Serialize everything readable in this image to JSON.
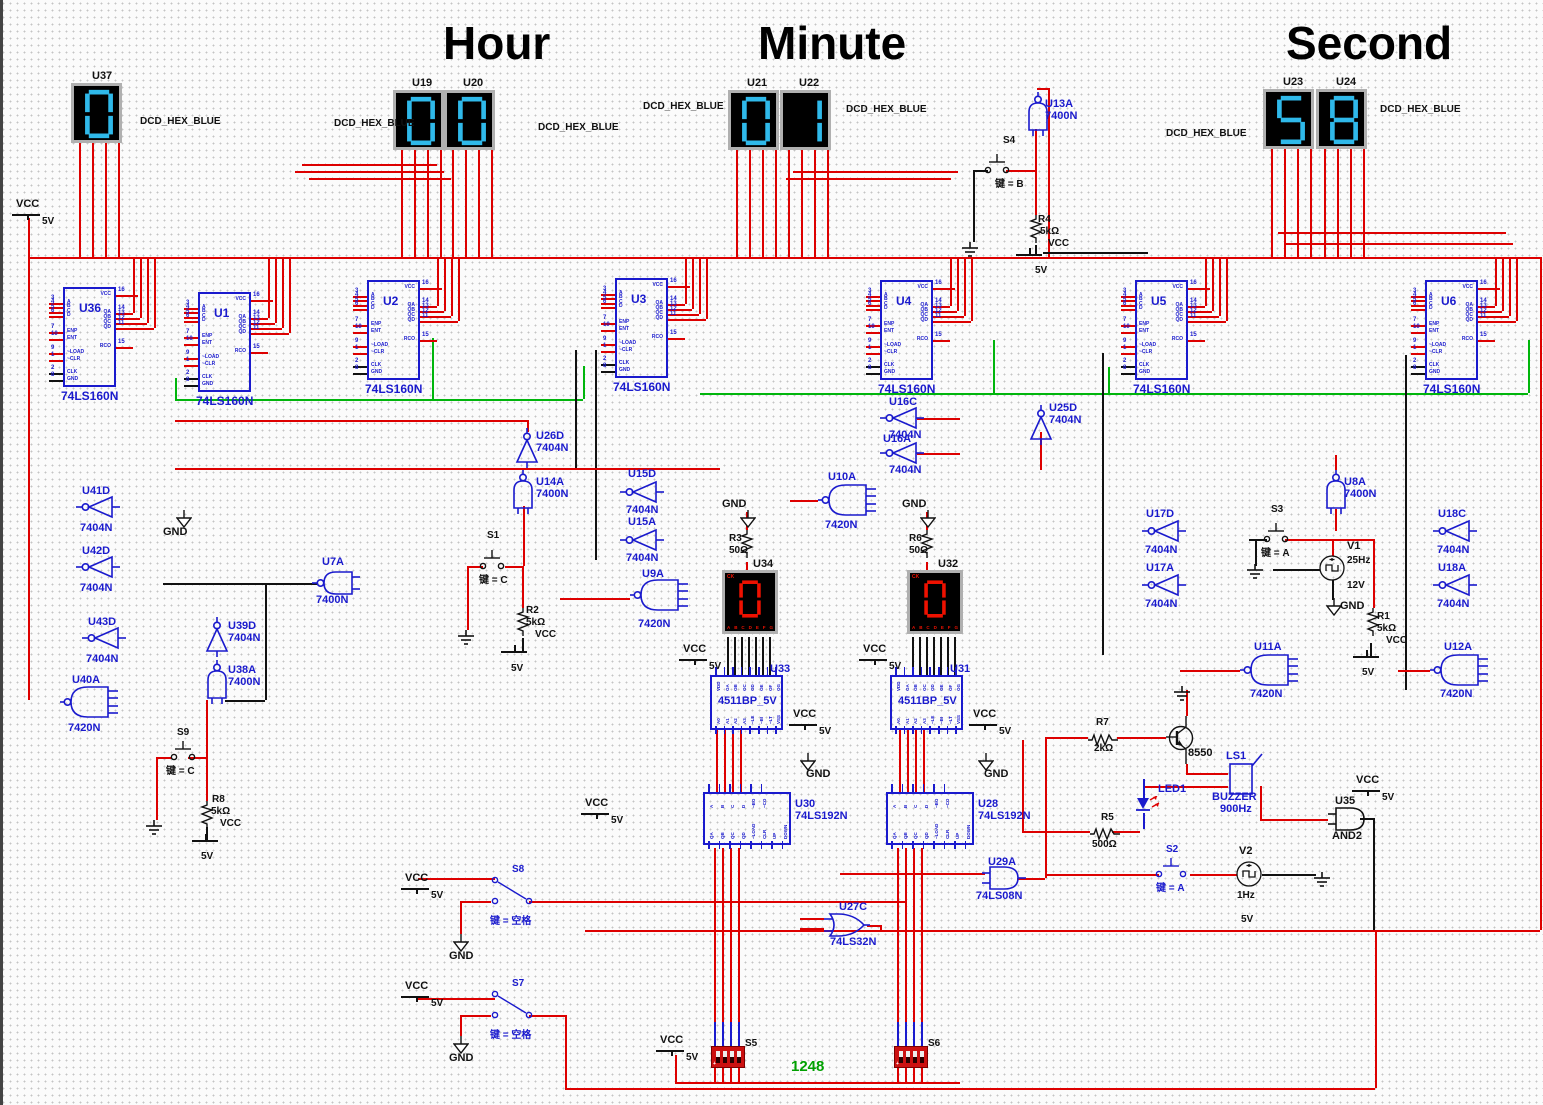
{
  "titles": {
    "hour": "Hour",
    "minute": "Minute",
    "second": "Second"
  },
  "colors": {
    "wire_red": "#dd0000",
    "wire_green": "#00b50c",
    "wire_black": "#111111",
    "component_blue": "#1a1acd",
    "segment_blue": "#2fb9ea",
    "segment_red": "#ee1100",
    "dip_red": "#cc1111",
    "label_green": "#00a000"
  },
  "display_captions": [
    {
      "text": "DCD_HEX_BLUE",
      "x": 140,
      "y": 116
    },
    {
      "text": "DCD_HEX_BLUE",
      "x": 334,
      "y": 118
    },
    {
      "text": "DCD_HEX_BLUE",
      "x": 538,
      "y": 122
    },
    {
      "text": "DCD_HEX_BLUE",
      "x": 643,
      "y": 101
    },
    {
      "text": "DCD_HEX_BLUE",
      "x": 846,
      "y": 104
    },
    {
      "text": "DCD_HEX_BLUE",
      "x": 1166,
      "y": 128
    },
    {
      "text": "DCD_HEX_BLUE",
      "x": 1380,
      "y": 104
    }
  ],
  "displays": [
    {
      "id": "U37",
      "digit": "0",
      "color": "blue",
      "x": 71,
      "y": 83,
      "lx": 92,
      "ly": 70
    },
    {
      "id": "U19",
      "digit": "0",
      "color": "blue",
      "x": 393,
      "y": 90,
      "lx": 412,
      "ly": 77
    },
    {
      "id": "U20",
      "digit": "0",
      "color": "blue",
      "x": 444,
      "y": 90,
      "lx": 463,
      "ly": 77
    },
    {
      "id": "U21",
      "digit": "0",
      "color": "blue",
      "x": 728,
      "y": 90,
      "lx": 747,
      "ly": 77
    },
    {
      "id": "U22",
      "digit": "1",
      "color": "blue",
      "x": 780,
      "y": 90,
      "lx": 799,
      "ly": 77
    },
    {
      "id": "U23",
      "digit": "5",
      "color": "blue",
      "x": 1263,
      "y": 89,
      "lx": 1283,
      "ly": 76
    },
    {
      "id": "U24",
      "digit": "8",
      "color": "blue",
      "x": 1316,
      "y": 89,
      "lx": 1336,
      "ly": 76
    },
    {
      "id": "U34",
      "digit": "0",
      "color": "red",
      "x": 722,
      "y": 570,
      "lx": 753,
      "ly": 558
    },
    {
      "id": "U32",
      "digit": "0",
      "color": "red",
      "x": 907,
      "y": 570,
      "lx": 938,
      "ly": 558
    }
  ],
  "red_display": {
    "ck": "CK",
    "pins": [
      "A",
      "B",
      "C",
      "D",
      "E",
      "F",
      "G"
    ]
  },
  "counters": {
    "part": "74LS160N",
    "left_pins": [
      "A",
      "B",
      "C",
      "D",
      "ENP",
      "ENT",
      "~LOAD",
      "~CLR",
      "CLK",
      "GND"
    ],
    "left_nums": [
      "3",
      "4",
      "5",
      "6",
      "7",
      "10",
      "9",
      "1",
      "2",
      "8"
    ],
    "left_offs": [
      16,
      20,
      25,
      29,
      45,
      52,
      66,
      73,
      86,
      93
    ],
    "right_pins": [
      "VCC",
      "QA",
      "QB",
      "QC",
      "QD",
      "RCO"
    ],
    "right_nums": [
      "16",
      "14",
      "13",
      "12",
      "11",
      "15"
    ],
    "right_offs": [
      8,
      26,
      31,
      36,
      41,
      60
    ],
    "items": [
      {
        "id": "U36",
        "x": 63,
        "y": 287
      },
      {
        "id": "U1",
        "x": 198,
        "y": 292
      },
      {
        "id": "U2",
        "x": 367,
        "y": 280
      },
      {
        "id": "U3",
        "x": 615,
        "y": 278
      },
      {
        "id": "U4",
        "x": 880,
        "y": 280
      },
      {
        "id": "U5",
        "x": 1135,
        "y": 280
      },
      {
        "id": "U6",
        "x": 1425,
        "y": 280
      }
    ]
  },
  "decoders": {
    "part": "4511BP_5V",
    "top_pins": [
      "VDD",
      "OA",
      "OB",
      "OC",
      "OD",
      "OE",
      "OF",
      "OG"
    ],
    "bottom_pins": [
      "A0",
      "A1",
      "A2",
      "A3",
      "~LE",
      "~BI",
      "~LT",
      "VSS"
    ],
    "items": [
      {
        "id": "U33",
        "x": 710,
        "y": 675
      },
      {
        "id": "U31",
        "x": 890,
        "y": 675
      }
    ]
  },
  "updown_counters": {
    "part": "74LS192N",
    "top_pins": [
      "A",
      "B",
      "C",
      "D",
      "~BO",
      "~CO"
    ],
    "bottom_pins": [
      "QA",
      "QB",
      "QC",
      "QD",
      "~LOAD",
      "CLR",
      "UP",
      "DOWN"
    ],
    "items": [
      {
        "id": "U30",
        "x": 703,
        "y": 792
      },
      {
        "id": "U28",
        "x": 886,
        "y": 792
      }
    ]
  },
  "gates": [
    {
      "id": "U41D",
      "part": "7404N",
      "type": "inv",
      "orient": "left",
      "x": 76,
      "y": 495,
      "ix": 82,
      "iy": 485,
      "px": 80,
      "py": 522
    },
    {
      "id": "U42D",
      "part": "7404N",
      "type": "inv",
      "orient": "left",
      "x": 76,
      "y": 555,
      "ix": 82,
      "iy": 545,
      "px": 80,
      "py": 582
    },
    {
      "id": "U43D",
      "part": "7404N",
      "type": "inv",
      "orient": "left",
      "x": 82,
      "y": 626,
      "ix": 88,
      "iy": 616,
      "px": 86,
      "py": 653
    },
    {
      "id": "U40A",
      "part": "7420N",
      "type": "nand4",
      "orient": "left",
      "x": 60,
      "y": 685,
      "ix": 72,
      "iy": 674,
      "px": 68,
      "py": 722
    },
    {
      "id": "U39D",
      "part": "7404N",
      "type": "inv",
      "orient": "up",
      "x": 205,
      "y": 617,
      "ix": 228,
      "iy": 620,
      "px": 228,
      "py": 632
    },
    {
      "id": "U38A",
      "part": "7400N",
      "type": "nand2",
      "orient": "up",
      "x": 205,
      "y": 660,
      "ix": 228,
      "iy": 664,
      "px": 228,
      "py": 676
    },
    {
      "id": "U7A",
      "part": "7400N",
      "type": "nand2",
      "orient": "left",
      "x": 312,
      "y": 570,
      "ix": 322,
      "iy": 556,
      "px": 316,
      "py": 594
    },
    {
      "id": "U26D",
      "part": "7404N",
      "type": "inv",
      "orient": "up",
      "x": 515,
      "y": 428,
      "ix": 536,
      "iy": 430,
      "px": 536,
      "py": 442
    },
    {
      "id": "U14A",
      "part": "7400N",
      "type": "nand2",
      "orient": "up",
      "x": 511,
      "y": 470,
      "ix": 536,
      "iy": 476,
      "px": 536,
      "py": 488
    },
    {
      "id": "U15D",
      "part": "7404N",
      "type": "inv",
      "orient": "left",
      "x": 620,
      "y": 480,
      "ix": 628,
      "iy": 468,
      "px": 626,
      "py": 504
    },
    {
      "id": "U15A",
      "part": "7404N",
      "type": "inv",
      "orient": "left",
      "x": 620,
      "y": 528,
      "ix": 628,
      "iy": 516,
      "px": 626,
      "py": 552
    },
    {
      "id": "U9A",
      "part": "7420N",
      "type": "nand4",
      "orient": "left",
      "x": 630,
      "y": 578,
      "ix": 642,
      "iy": 568,
      "px": 638,
      "py": 618
    },
    {
      "id": "U13A",
      "part": "7400N",
      "type": "nand2",
      "orient": "up",
      "x": 1026,
      "y": 92,
      "ix": 1045,
      "iy": 98,
      "px": 1045,
      "py": 110
    },
    {
      "id": "U16C",
      "part": "7404N",
      "type": "inv",
      "orient": "left",
      "x": 880,
      "y": 406,
      "ix": 889,
      "iy": 396,
      "px": 889,
      "py": 429
    },
    {
      "id": "U16A",
      "part": "7404N",
      "type": "inv",
      "orient": "left",
      "x": 880,
      "y": 441,
      "ix": 883,
      "iy": 433,
      "px": 889,
      "py": 464
    },
    {
      "id": "U10A",
      "part": "7420N",
      "type": "nand4",
      "orient": "left",
      "x": 818,
      "y": 483,
      "ix": 828,
      "iy": 471,
      "px": 825,
      "py": 519
    },
    {
      "id": "U25D",
      "part": "7404N",
      "type": "inv",
      "orient": "up",
      "x": 1029,
      "y": 405,
      "ix": 1049,
      "iy": 402,
      "px": 1049,
      "py": 414
    },
    {
      "id": "U17D",
      "part": "7404N",
      "type": "inv",
      "orient": "left",
      "x": 1142,
      "y": 519,
      "ix": 1146,
      "iy": 508,
      "px": 1145,
      "py": 544
    },
    {
      "id": "U17A",
      "part": "7404N",
      "type": "inv",
      "orient": "left",
      "x": 1142,
      "y": 573,
      "ix": 1146,
      "iy": 562,
      "px": 1145,
      "py": 598
    },
    {
      "id": "U8A",
      "part": "7400N",
      "type": "nand2",
      "orient": "up",
      "x": 1324,
      "y": 470,
      "ix": 1344,
      "iy": 476,
      "px": 1344,
      "py": 488
    },
    {
      "id": "U18C",
      "part": "7404N",
      "type": "inv",
      "orient": "left",
      "x": 1433,
      "y": 519,
      "ix": 1438,
      "iy": 508,
      "px": 1437,
      "py": 544
    },
    {
      "id": "U18A",
      "part": "7404N",
      "type": "inv",
      "orient": "left",
      "x": 1433,
      "y": 573,
      "ix": 1438,
      "iy": 562,
      "px": 1437,
      "py": 598
    },
    {
      "id": "U11A",
      "part": "7420N",
      "type": "nand4",
      "orient": "left",
      "x": 1240,
      "y": 653,
      "ix": 1254,
      "iy": 641,
      "px": 1250,
      "py": 688
    },
    {
      "id": "U12A",
      "part": "7420N",
      "type": "nand4",
      "orient": "left",
      "x": 1430,
      "y": 653,
      "ix": 1444,
      "iy": 641,
      "px": 1440,
      "py": 688
    },
    {
      "id": "U29A",
      "part": "74LS08N",
      "type": "and2",
      "orient": "right",
      "x": 982,
      "y": 865,
      "ix": 988,
      "iy": 856,
      "px": 976,
      "py": 890
    },
    {
      "id": "U27C",
      "part": "74LS32N",
      "type": "or2",
      "orient": "right",
      "x": 824,
      "y": 912,
      "ix": 839,
      "iy": 901,
      "px": 830,
      "py": 936
    },
    {
      "id": "U35",
      "part": "AND2",
      "type": "and2",
      "orient": "right",
      "x": 1328,
      "y": 806,
      "ix": 1335,
      "iy": 795,
      "px": 1332,
      "py": 830,
      "black": true
    }
  ],
  "switches": [
    {
      "id": "S1",
      "type": "spst",
      "x": 483,
      "y": 566,
      "key": "键 = C",
      "blue": false,
      "lx": 487,
      "ly": 530,
      "kx": 479,
      "ky": 571
    },
    {
      "id": "S2",
      "type": "spst",
      "x": 1159,
      "y": 874,
      "key": "键 = A",
      "blue": true,
      "lx": 1166,
      "ly": 844,
      "kx": 1156,
      "ky": 879,
      "gap": 24
    },
    {
      "id": "S3",
      "type": "spst",
      "x": 1267,
      "y": 539,
      "key": "键 = A",
      "blue": false,
      "lx": 1271,
      "ly": 504,
      "kx": 1261,
      "ky": 544
    },
    {
      "id": "S4",
      "type": "spst",
      "x": 988,
      "y": 170,
      "key": "键 = B",
      "blue": false,
      "lx": 1003,
      "ly": 135,
      "kx": 995,
      "ky": 175
    },
    {
      "id": "S9",
      "type": "spst",
      "x": 174,
      "y": 757,
      "key": "键 = C",
      "blue": false,
      "lx": 177,
      "ly": 727,
      "kx": 166,
      "ky": 762
    },
    {
      "id": "S8",
      "type": "spdt",
      "x": 495,
      "y": 880,
      "key": "键 = 空格",
      "blue": true,
      "lx": 512,
      "ly": 864,
      "kx": 490,
      "ky": 912
    },
    {
      "id": "S7",
      "type": "spdt",
      "x": 495,
      "y": 994,
      "key": "键 = 空格",
      "blue": true,
      "lx": 512,
      "ly": 978,
      "kx": 490,
      "ky": 1026
    },
    {
      "id": "S5",
      "type": "dip",
      "x": 711,
      "y": 1046,
      "lx": 745,
      "ly": 1038
    },
    {
      "id": "S6",
      "type": "dip",
      "x": 894,
      "y": 1046,
      "lx": 928,
      "ly": 1038
    }
  ],
  "resistors": [
    {
      "id": "R1",
      "value": "5kΩ",
      "x": 1366,
      "y": 608,
      "orient": "v",
      "labels": [
        [
          "R1",
          1377,
          611
        ],
        [
          "5kΩ",
          1377,
          623
        ],
        [
          "VCC",
          1386,
          635
        ]
      ],
      "bar": [
        1353,
        656
      ],
      "fv": [
        1362,
        663
      ]
    },
    {
      "id": "R2",
      "value": "5kΩ",
      "x": 516,
      "y": 608,
      "orient": "v",
      "labels": [
        [
          "R2",
          526,
          605
        ],
        [
          "5kΩ",
          526,
          617
        ],
        [
          "VCC",
          535,
          629
        ]
      ],
      "bar": [
        501,
        651
      ],
      "fv": [
        511,
        659
      ]
    },
    {
      "id": "R3",
      "value": "50Ω",
      "x": 740,
      "y": 530,
      "orient": "v",
      "labels": [
        [
          "R3",
          729,
          533
        ],
        [
          "50Ω",
          729,
          545
        ]
      ]
    },
    {
      "id": "R4",
      "value": "5kΩ",
      "x": 1029,
      "y": 215,
      "orient": "v",
      "labels": [
        [
          "R4",
          1038,
          214
        ],
        [
          "5kΩ",
          1040,
          226
        ],
        [
          "VCC",
          1048,
          238
        ]
      ],
      "bar": [
        1016,
        254
      ],
      "fv": [
        1035,
        261
      ]
    },
    {
      "id": "R5",
      "value": "500Ω",
      "x": 1090,
      "y": 827,
      "orient": "h",
      "labels": [
        [
          "R5",
          1101,
          812
        ],
        [
          "500Ω",
          1092,
          839
        ]
      ]
    },
    {
      "id": "R6",
      "value": "50Ω",
      "x": 920,
      "y": 530,
      "orient": "v",
      "labels": [
        [
          "R6",
          909,
          533
        ],
        [
          "50Ω",
          909,
          545
        ]
      ]
    },
    {
      "id": "R7",
      "value": "2kΩ",
      "x": 1088,
      "y": 733,
      "orient": "h",
      "labels": [
        [
          "R7",
          1096,
          717
        ],
        [
          "2kΩ",
          1094,
          743
        ]
      ]
    },
    {
      "id": "R8",
      "value": "5kΩ",
      "x": 200,
      "y": 801,
      "orient": "v",
      "labels": [
        [
          "R8",
          212,
          794
        ],
        [
          "5kΩ",
          211,
          806
        ],
        [
          "VCC",
          220,
          818
        ]
      ],
      "bar": [
        192,
        840
      ],
      "fv": [
        201,
        847
      ]
    }
  ],
  "sources": [
    {
      "id": "V1",
      "freq": "25Hz",
      "volt": "12V",
      "cx": 1332,
      "cy": 568,
      "lx": 1347,
      "ly": 540,
      "fx": 1347,
      "fy": 555,
      "vx": 1347,
      "vy": 568
    },
    {
      "id": "V2",
      "freq": "1Hz",
      "volt": "5V",
      "cx": 1249,
      "cy": 874,
      "lx": 1239,
      "ly": 845,
      "fx": 1237,
      "fy": 890,
      "vx": 1241,
      "vy": 902
    }
  ],
  "misc": {
    "transistor": "8550",
    "transistor_x": 1188,
    "transistor_y": 747,
    "buzzer_id": "LS1",
    "buzzer_name": "BUZZER",
    "buzzer_freq": "900Hz",
    "led": "LED1",
    "dip_caption": "1248",
    "dip_caption_x": 791,
    "dip_caption_y": 1058
  },
  "power": {
    "vcc_label": "VCC",
    "v5_label": "5V",
    "gnd_label": "GND",
    "vcc_points": [
      [
        16,
        198
      ],
      [
        683,
        643
      ],
      [
        863,
        643
      ],
      [
        793,
        708
      ],
      [
        973,
        708
      ],
      [
        585,
        797
      ],
      [
        405,
        872
      ],
      [
        405,
        980
      ],
      [
        660,
        1034
      ],
      [
        1356,
        774
      ]
    ],
    "gnd_arrows": [
      [
        740,
        510
      ],
      [
        920,
        510
      ],
      [
        176,
        510
      ],
      [
        800,
        753
      ],
      [
        978,
        753
      ],
      [
        1326,
        598
      ],
      [
        453,
        934
      ],
      [
        453,
        1036
      ]
    ],
    "gnd_texts": [
      [
        722,
        498
      ],
      [
        902,
        498
      ],
      [
        163,
        526
      ],
      [
        806,
        768
      ],
      [
        984,
        768
      ],
      [
        1340,
        600
      ],
      [
        449,
        950
      ],
      [
        449,
        1052
      ]
    ],
    "earth_points": [
      [
        960,
        242
      ],
      [
        456,
        630
      ],
      [
        144,
        820
      ],
      [
        1245,
        564
      ],
      [
        1312,
        872
      ],
      [
        1172,
        686
      ]
    ]
  }
}
